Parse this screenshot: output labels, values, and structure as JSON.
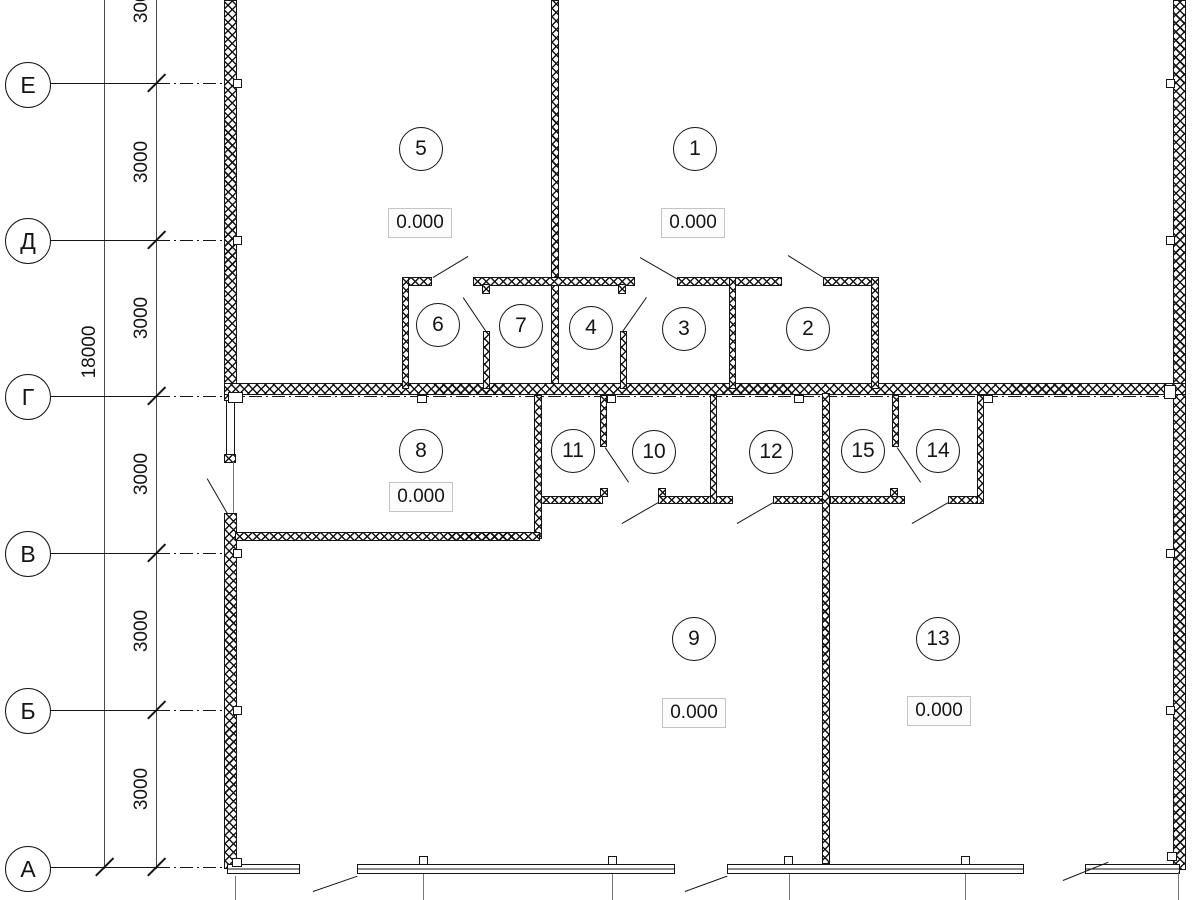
{
  "axes": {
    "e": "Е",
    "d": "Д",
    "g": "Г",
    "v": "В",
    "b": "Б",
    "a": "А"
  },
  "dimensions": {
    "interval": "3000",
    "overall": "18000"
  },
  "rooms": {
    "r1": {
      "num": "1",
      "elev": "0.000"
    },
    "r2": {
      "num": "2"
    },
    "r3": {
      "num": "3"
    },
    "r4": {
      "num": "4"
    },
    "r5": {
      "num": "5",
      "elev": "0.000"
    },
    "r6": {
      "num": "6"
    },
    "r7": {
      "num": "7"
    },
    "r8": {
      "num": "8",
      "elev": "0.000"
    },
    "r9": {
      "num": "9",
      "elev": "0.000"
    },
    "r10": {
      "num": "10"
    },
    "r11": {
      "num": "11"
    },
    "r12": {
      "num": "12"
    },
    "r13": {
      "num": "13",
      "elev": "0.000"
    },
    "r14": {
      "num": "14"
    },
    "r15": {
      "num": "15"
    }
  }
}
